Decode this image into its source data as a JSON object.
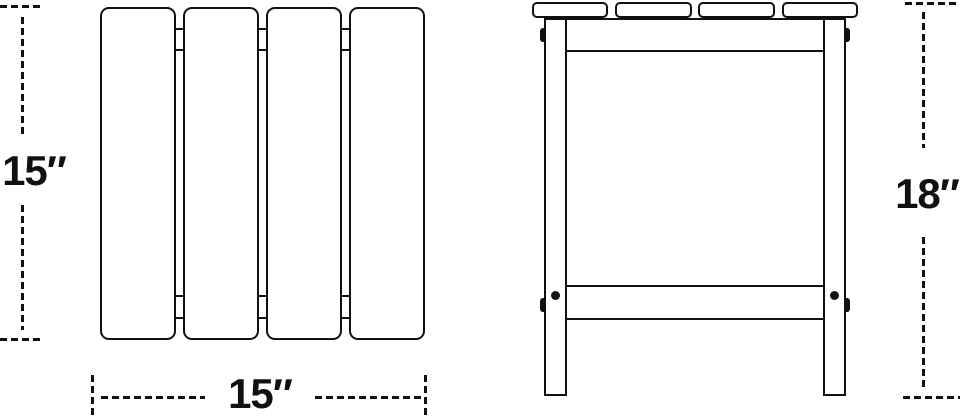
{
  "diagram": {
    "type": "product-dimension-diagram",
    "subject": "slatted side table",
    "colors": {
      "line": "#111111",
      "fill": "#ffffff",
      "background": "#ffffff"
    },
    "top_view": {
      "slat_count": 4,
      "depth_label": "15″",
      "width_label": "15″"
    },
    "front_view": {
      "slat_count": 4,
      "height_label": "18″"
    }
  }
}
